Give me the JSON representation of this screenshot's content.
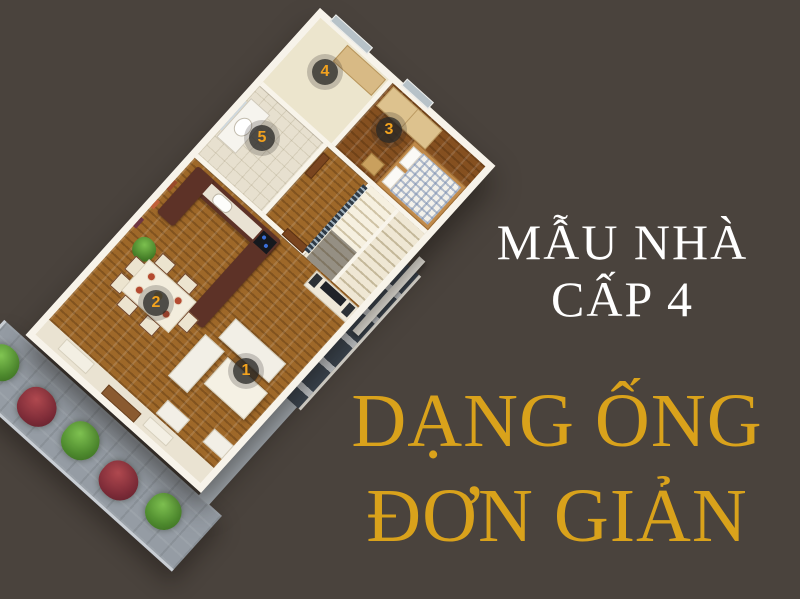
{
  "title": {
    "line1": "MẪU NHÀ",
    "line2": "CẤP 4",
    "color": "#ffffff"
  },
  "subtitle": {
    "line1": "DẠNG ỐNG",
    "line2": "ĐƠN GIẢN",
    "color": "#d9a21b"
  },
  "floor_plan": {
    "type": "3d-floor-plan",
    "rooms": [
      {
        "number": "1",
        "name": "living-room"
      },
      {
        "number": "2",
        "name": "dining-area"
      },
      {
        "number": "3",
        "name": "bedroom"
      },
      {
        "number": "4",
        "name": "back-room"
      },
      {
        "number": "5",
        "name": "bathroom"
      }
    ],
    "badge_bg": "#2a2826",
    "badge_number_color": "#f2a21e"
  },
  "colors": {
    "background": "#4a433d",
    "wall": "#f7f3ea",
    "wood_floor": "#9e6829",
    "path_gray": "#959ca4",
    "bush_green": "#4e8a2e",
    "bush_red": "#7e2c38",
    "gold": "#d9a21b"
  }
}
